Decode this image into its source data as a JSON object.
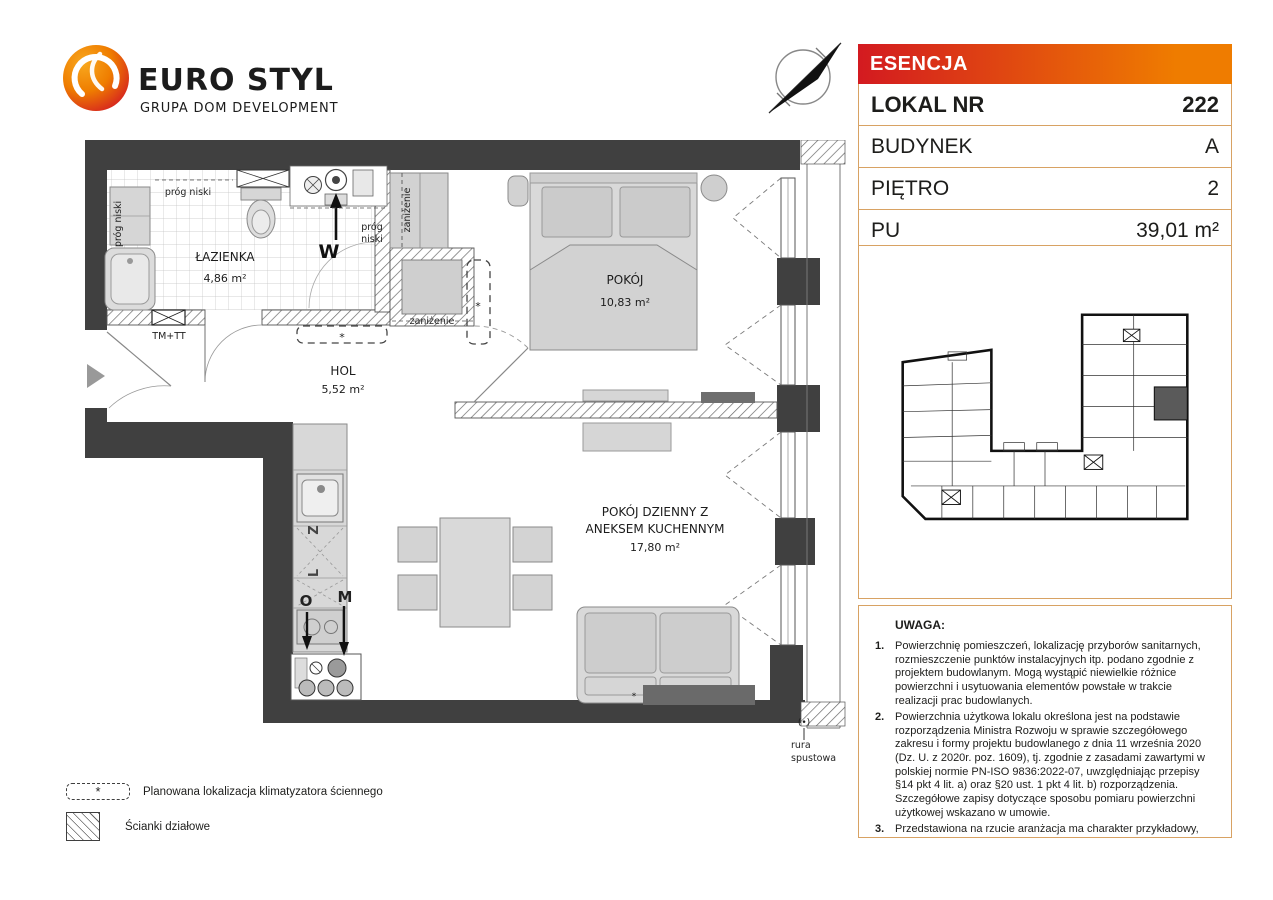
{
  "logo": {
    "brand": "EURO STYL",
    "subtitle": "GRUPA DOM DEVELOPMENT"
  },
  "info_panel": {
    "project": "ESENCJA",
    "rows": [
      {
        "label": "LOKAL NR",
        "value": "222"
      },
      {
        "label": "BUDYNEK",
        "value": "A"
      },
      {
        "label": "PIĘTRO",
        "value": "2"
      },
      {
        "label": "PU",
        "value": "39,01 m²"
      }
    ],
    "colors": {
      "gradient_from": "#D31A20",
      "gradient_to": "#EF7C00",
      "border": "#D8A263"
    }
  },
  "plan": {
    "rooms": [
      {
        "name": "ŁAZIENKA",
        "area": "4,86 m²"
      },
      {
        "name": "HOL",
        "area": "5,52 m²"
      },
      {
        "name": "POKÓJ",
        "area": "10,83 m²"
      },
      {
        "name_line1": "POKÓJ DZIENNY Z",
        "name_line2": "ANEKSEM KUCHENNYM",
        "area": "17,80 m²"
      }
    ],
    "labels": {
      "prog_niski": "próg niski",
      "prog": "próg",
      "niski": "niski",
      "zanizenie": "zaniżenie",
      "tm_tt": "TM+TT",
      "w": "W",
      "z": "Z",
      "l": "L",
      "o": "O",
      "m": "M",
      "asterisk": "*",
      "drain_symbol": "(•)",
      "rura_line1": "rura",
      "rura_line2": "spustowa"
    },
    "colors": {
      "wall": "#404040",
      "furniture": "#d3d3d3"
    }
  },
  "legend": {
    "items": [
      {
        "symbol": "ac-dashed-box",
        "label": "Planowana lokalizacja klimatyzatora ściennego"
      },
      {
        "symbol": "partition-hatch",
        "label": "Ścianki działowe"
      }
    ]
  },
  "notes": {
    "title": "UWAGA:",
    "items": [
      {
        "num": "1.",
        "text": "Powierzchnię pomieszczeń, lokalizację przyborów sanitarnych, rozmieszczenie punktów instalacyjnych itp. podano zgodnie z projektem budowlanym. Mogą wystąpić niewielkie różnice powierzchni i usytuowania elementów powstałe w trakcie realizacji prac budowlanych."
      },
      {
        "num": "2.",
        "text": "Powierzchnia użytkowa lokalu określona jest na podstawie rozporządzenia Ministra Rozwoju w sprawie szczegółowego zakresu i formy projektu budowlanego z dnia 11 września 2020 (Dz. U. z 2020r. poz. 1609), tj. zgodnie z zasadami zawartymi w polskiej normie PN-ISO 9836:2022-07, uwzględniając przepisy §14 pkt 4 lit. a) oraz §20 ust. 1 pkt 4 lit. b) rozporządzenia. Szczegółowe zapisy dotyczące sposobu pomiaru powierzchni użytkowej wskazano w umowie."
      },
      {
        "num": "3.",
        "text": "Przedstawiona na rzucie aranżacja ma charakter przykładowy, umeblowanie i zabudowy instalacyjne nie stanowią wyposażenia nabywanego lokalu."
      }
    ]
  }
}
